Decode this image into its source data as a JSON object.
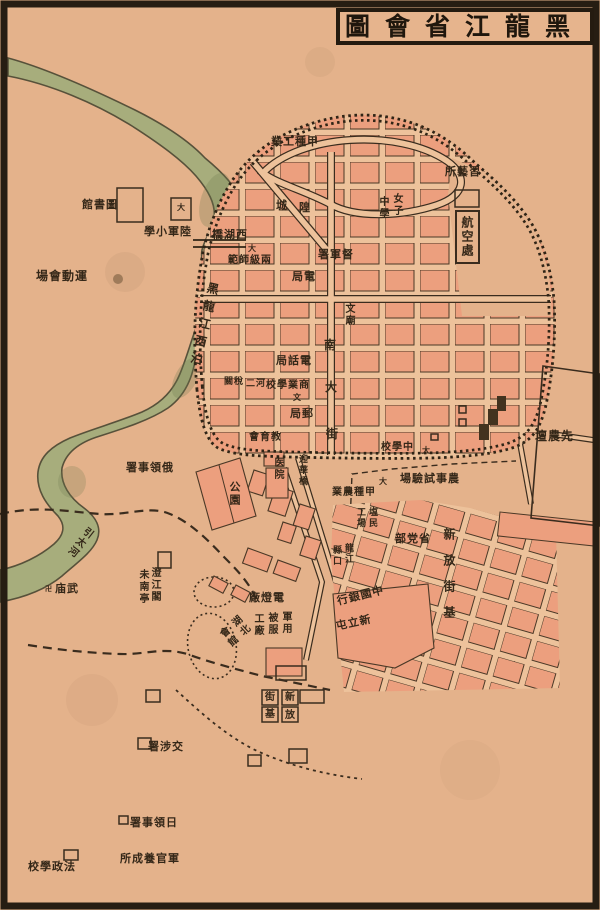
{
  "title": {
    "display_text": "圖會省江龍黑",
    "reading": "黑龍江省會圖",
    "translation": "Map of the Heilongjiang Provincial Capital"
  },
  "colors": {
    "paper": "#e4b28b",
    "street": "#edc29b",
    "block": "#ec9f7e",
    "river": "#a7ad7c",
    "river_edge": "#57513a",
    "ink": "#3a2c1e",
    "title_ink": "#20170d"
  },
  "labels": [
    {
      "name": "library-label",
      "text": "館書圖",
      "reading": "圖書館",
      "x": 82,
      "y": 199,
      "size": 11,
      "v": false
    },
    {
      "name": "sports-ground-label",
      "text": "場會動運",
      "reading": "運動會場",
      "x": 36,
      "y": 270,
      "size": 12,
      "v": false
    },
    {
      "name": "army-primary-school-label",
      "text": "學小軍陸",
      "reading": "陸軍小學",
      "x": 144,
      "y": 226,
      "size": 11,
      "v": false
    },
    {
      "name": "school-mark-army",
      "text": "大",
      "x": 177,
      "y": 204,
      "size": 8,
      "v": false
    },
    {
      "name": "west-lake-bridge-label",
      "text": "橋湖西",
      "reading": "西湖橋",
      "x": 212,
      "y": 229,
      "size": 11,
      "v": false
    },
    {
      "name": "normal-school-label",
      "text": "範師級兩",
      "reading": "兩級師範",
      "x": 228,
      "y": 256,
      "size": 10,
      "v": false
    },
    {
      "name": "school-mark-normal",
      "text": "大",
      "x": 248,
      "y": 245,
      "size": 8,
      "v": false
    },
    {
      "name": "industrial-school-label",
      "text": "業工種甲",
      "reading": "甲種工業",
      "x": 271,
      "y": 136,
      "size": 11,
      "v": false
    },
    {
      "name": "workhouse-label",
      "text": "所藝習",
      "reading": "習藝所",
      "x": 445,
      "y": 166,
      "size": 11,
      "v": false
    },
    {
      "name": "aviation-office-label",
      "text": "航空處",
      "x": 461,
      "y": 216,
      "size": 12,
      "v": true
    },
    {
      "name": "city-god-char-1",
      "text": "城",
      "x": 276,
      "y": 200,
      "size": 11,
      "v": false
    },
    {
      "name": "city-god-char-2",
      "text": "隍",
      "x": 299,
      "y": 202,
      "size": 11,
      "v": false
    },
    {
      "name": "girls-school-col-right",
      "text": "女子",
      "x": 391,
      "y": 193,
      "size": 10,
      "v": true
    },
    {
      "name": "girls-school-col-left",
      "text": "中學",
      "x": 377,
      "y": 196,
      "size": 10,
      "v": true
    },
    {
      "name": "military-governor-label",
      "text": "署軍督",
      "reading": "督軍署",
      "x": 318,
      "y": 249,
      "size": 11,
      "v": false
    },
    {
      "name": "electric-bureau-label",
      "text": "局電",
      "reading": "電局",
      "x": 292,
      "y": 271,
      "size": 11,
      "v": false
    },
    {
      "name": "confucian-temple-label",
      "text": "文廟",
      "x": 343,
      "y": 303,
      "size": 10,
      "v": true
    },
    {
      "name": "south-street-char-1",
      "text": "南",
      "x": 324,
      "y": 339,
      "size": 12,
      "v": false
    },
    {
      "name": "south-street-char-2",
      "text": "大",
      "x": 325,
      "y": 381,
      "size": 12,
      "v": false
    },
    {
      "name": "south-street-char-3",
      "text": "街",
      "x": 326,
      "y": 428,
      "size": 12,
      "v": false
    },
    {
      "name": "telephone-bureau-label",
      "text": "局話電",
      "reading": "電話局",
      "x": 276,
      "y": 355,
      "size": 11,
      "v": false
    },
    {
      "name": "customs-label",
      "text": "關稅",
      "reading": "稅關",
      "x": 224,
      "y": 378,
      "size": 9,
      "v": false
    },
    {
      "name": "erhe-label",
      "text": "二河",
      "x": 246,
      "y": 380,
      "size": 9,
      "v": false
    },
    {
      "name": "commercial-school-label",
      "text": "校學業商",
      "reading": "商業學校",
      "x": 266,
      "y": 381,
      "size": 10,
      "v": false
    },
    {
      "name": "small-wen-label",
      "text": "文",
      "x": 293,
      "y": 394,
      "size": 8,
      "v": false
    },
    {
      "name": "post-office-label",
      "text": "局郵",
      "reading": "郵局",
      "x": 290,
      "y": 408,
      "size": 11,
      "v": false
    },
    {
      "name": "education-assoc-label",
      "text": "會育教",
      "reading": "教育會",
      "x": 249,
      "y": 433,
      "size": 10,
      "v": false
    },
    {
      "name": "xiannongtan-label",
      "text": "壇農先",
      "reading": "先農壇",
      "x": 535,
      "y": 430,
      "size": 12,
      "v": false
    },
    {
      "name": "agri-station-label",
      "text": "場驗試事農",
      "reading": "農事試驗場",
      "x": 400,
      "y": 473,
      "size": 11,
      "v": false
    },
    {
      "name": "middle-school-label",
      "text": "校學中",
      "reading": "中學校",
      "x": 381,
      "y": 443,
      "size": 10,
      "v": false
    },
    {
      "name": "school-mark-middle",
      "text": "大",
      "x": 422,
      "y": 447,
      "size": 8,
      "v": false
    },
    {
      "name": "agri-school-label",
      "text": "業農種甲",
      "reading": "甲種農業",
      "x": 332,
      "y": 488,
      "size": 10,
      "v": false
    },
    {
      "name": "school-mark-agri",
      "text": "大",
      "x": 379,
      "y": 478,
      "size": 8,
      "v": false
    },
    {
      "name": "salt-works-col-right",
      "text": "塩民",
      "x": 367,
      "y": 507,
      "size": 9,
      "v": true
    },
    {
      "name": "salt-works-col-left",
      "text": "工場",
      "x": 355,
      "y": 507,
      "size": 9,
      "v": true
    },
    {
      "name": "longjiang-county-col-right",
      "text": "龍江",
      "x": 343,
      "y": 543,
      "size": 9,
      "v": true
    },
    {
      "name": "longjiang-county-col-left",
      "text": "縣口",
      "x": 331,
      "y": 545,
      "size": 9,
      "v": true
    },
    {
      "name": "party-hq-label",
      "text": "部党省",
      "reading": "省党部",
      "x": 395,
      "y": 533,
      "size": 11,
      "v": false
    },
    {
      "name": "new-district-label",
      "text": "新放街基",
      "x": 443,
      "y": 528,
      "size": 12,
      "v": true,
      "ls": 14
    },
    {
      "name": "bank-of-china-label",
      "text": "行銀國中",
      "reading": "中國銀行",
      "x": 336,
      "y": 596,
      "size": 11,
      "v": false,
      "rot": -14
    },
    {
      "name": "xinlitun-label",
      "text": "屯立新",
      "reading": "新立屯",
      "x": 335,
      "y": 621,
      "size": 11,
      "v": false,
      "rot": -12
    },
    {
      "name": "electric-plant-label",
      "text": "廠燈電",
      "reading": "電燈廠",
      "x": 249,
      "y": 592,
      "size": 11,
      "v": false
    },
    {
      "name": "clothing-factory-col-1",
      "text": "軍用",
      "x": 280,
      "y": 611,
      "size": 10,
      "v": true
    },
    {
      "name": "clothing-factory-col-2",
      "text": "被服",
      "x": 266,
      "y": 612,
      "size": 10,
      "v": true
    },
    {
      "name": "clothing-factory-col-3",
      "text": "工廠",
      "x": 252,
      "y": 613,
      "size": 10,
      "v": true
    },
    {
      "name": "hubei-guild-col-right",
      "text": "湖北",
      "x": 228,
      "y": 622,
      "size": 10,
      "v": true,
      "rot": -42
    },
    {
      "name": "hubei-guild-col-left",
      "text": "會館",
      "x": 216,
      "y": 633,
      "size": 10,
      "v": true,
      "rot": -42
    },
    {
      "name": "park-label",
      "text": "公園",
      "x": 229,
      "y": 481,
      "size": 11,
      "v": true
    },
    {
      "name": "russian-consulate-label",
      "text": "署事領俄",
      "reading": "俄領事署",
      "x": 126,
      "y": 462,
      "size": 11,
      "v": false
    },
    {
      "name": "hospital-label",
      "text": "医院",
      "x": 272,
      "y": 457,
      "size": 10,
      "v": true
    },
    {
      "name": "yinghua-bridge-label",
      "text": "迎華橋",
      "x": 297,
      "y": 454,
      "size": 9,
      "v": true
    },
    {
      "name": "chengjiang-pavilion-label",
      "text": "澄江閣",
      "x": 149,
      "y": 567,
      "size": 10,
      "v": true
    },
    {
      "name": "weinan-pavilion-label",
      "text": "未南亭",
      "x": 137,
      "y": 569,
      "size": 10,
      "v": true
    },
    {
      "name": "military-temple-label",
      "text": "庙武",
      "reading": "武庙",
      "x": 55,
      "y": 583,
      "size": 11,
      "v": false
    },
    {
      "name": "temple-mark",
      "text": "卍",
      "x": 45,
      "y": 586,
      "size": 7,
      "v": false
    },
    {
      "name": "yintai-river-label",
      "text": "引太河",
      "x": 86,
      "y": 524,
      "size": 10,
      "v": true,
      "rot": 38
    },
    {
      "name": "west-bay-river-label",
      "text": "黑龍江西泊",
      "x": 208,
      "y": 281,
      "size": 12,
      "v": true,
      "rot": 13,
      "ls": 6
    },
    {
      "name": "negotiations-office-label",
      "text": "署涉交",
      "reading": "交涉署",
      "x": 148,
      "y": 741,
      "size": 11,
      "v": false
    },
    {
      "name": "japan-consulate-label",
      "text": "署事領日",
      "reading": "日領事署",
      "x": 130,
      "y": 817,
      "size": 11,
      "v": false
    },
    {
      "name": "officer-training-label",
      "text": "所成養官軍",
      "reading": "軍官養成所",
      "x": 120,
      "y": 853,
      "size": 11,
      "v": false
    },
    {
      "name": "law-school-label",
      "text": "校學政法",
      "reading": "法政學校",
      "x": 28,
      "y": 861,
      "size": 11,
      "v": false
    },
    {
      "name": "block-char-jie",
      "text": "街",
      "x": 265,
      "y": 693,
      "size": 10,
      "v": false
    },
    {
      "name": "block-char-xin",
      "text": "新",
      "x": 285,
      "y": 693,
      "size": 10,
      "v": false
    },
    {
      "name": "block-char-ji",
      "text": "基",
      "x": 265,
      "y": 710,
      "size": 10,
      "v": false
    },
    {
      "name": "block-char-fang",
      "text": "放",
      "x": 285,
      "y": 711,
      "size": 10,
      "v": false
    }
  ]
}
